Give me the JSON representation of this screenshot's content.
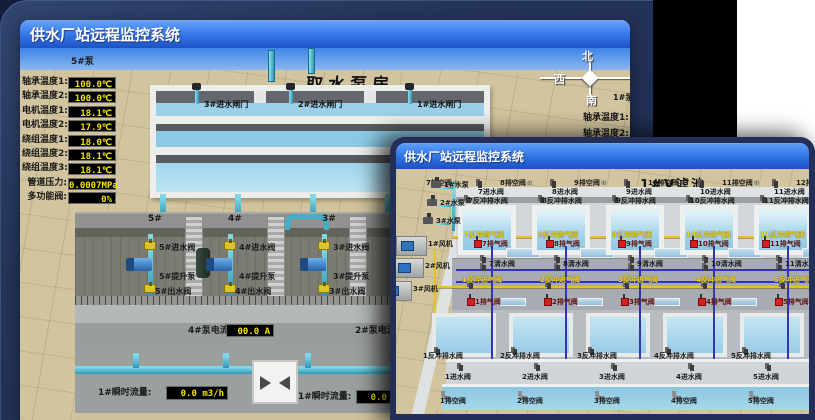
{
  "back_window": {
    "title": "供水厂站远程监控系统",
    "scene_title": "取水泵房",
    "pump_monitor": {
      "pump_label": "5#泵",
      "rows": [
        {
          "label": "轴承温度1:",
          "value": "100.0℃"
        },
        {
          "label": "轴承温度2:",
          "value": "100.0℃"
        },
        {
          "label": "电机温度1:",
          "value": "18.1℃"
        },
        {
          "label": "电机温度2:",
          "value": "17.9℃"
        },
        {
          "label": "绕组温度1:",
          "value": "18.0℃"
        },
        {
          "label": "绕组温度2:",
          "value": "18.1℃"
        },
        {
          "label": "绕组温度3:",
          "value": "18.1℃"
        },
        {
          "label": "管道压力:",
          "value": "0.0007MPa"
        },
        {
          "label": "多功能阀:",
          "value": "0%"
        }
      ]
    },
    "right_monitor": {
      "pump_label": "1#泵",
      "labels": [
        "轴承温度1:",
        "轴承温度2:"
      ]
    },
    "intake_gates": [
      "3#进水闸门",
      "2#进水闸门",
      "1#进水闸门"
    ],
    "compass": {
      "north": "北",
      "west": "西",
      "south": "南"
    },
    "pump_room": {
      "bays": [
        "5#",
        "4#",
        "3#"
      ],
      "groups": [
        {
          "inlet": "5#进水阀",
          "pump": "5#提升泵",
          "outlet": "5#出水阀"
        },
        {
          "inlet": "4#进水阀",
          "pump": "4#提升泵",
          "outlet": "4#出水阀"
        },
        {
          "inlet": "3#进水阀",
          "pump": "3#提升泵",
          "outlet": "3#出水阀"
        }
      ],
      "current_displays": [
        {
          "label": "4#泵电流:",
          "value": "00.0 A"
        },
        {
          "label": "2#泵电流:",
          "value": "00.0 A"
        }
      ]
    },
    "flow_displays": [
      {
        "label": "1#瞬时流量:",
        "value": "0.0 m3/h"
      },
      {
        "label": "1#瞬时流量:",
        "value": "0.0 m3/h"
      }
    ]
  },
  "front_window": {
    "title": "供水厂站远程监控系统",
    "scene_title": "1#V滤池",
    "left_equipment": {
      "pumps": [
        "1#水泵",
        "2#水泵",
        "3#水泵"
      ],
      "fans": [
        "1#风机",
        "2#风机",
        "3#风机"
      ]
    },
    "top_cells": {
      "drain_valves": [
        "7排空阀",
        "8排空阀",
        "9排空阀",
        "10排空阀",
        "11排空阀",
        "12排空阀"
      ],
      "inlet_valves": [
        "7进水阀",
        "8进水阀",
        "9进水阀",
        "10进水阀",
        "11进水阀",
        "12进水阀"
      ],
      "backwash_drain_valves": [
        "7反冲排水阀",
        "8反冲排水阀",
        "9反冲排水阀",
        "10反冲排水阀",
        "11反冲排水阀"
      ],
      "air_inlet_valves": [
        "7反冲进气阀",
        "8反冲进气阀",
        "9反冲进气阀",
        "10反冲进气阀",
        "11反冲进气阀",
        "12反冲进气阀"
      ],
      "exhaust_valves": [
        "7排气阀",
        "8排气阀",
        "9排气阀",
        "10排气阀",
        "11排气阀"
      ],
      "clean_water_valves": [
        "7清水阀",
        "8清水阀",
        "9清水阀",
        "10清水阀",
        "11清水阀"
      ]
    },
    "bottom_cells": {
      "air_inlet_valves": [
        "1反冲进气阀",
        "2反冲进气阀",
        "3反冲进气阀",
        "4反冲进气阀",
        "5反冲进气阀"
      ],
      "exhaust_valves": [
        "1排气阀",
        "2排气阀",
        "3排气阀",
        "4排气阀",
        "5排气阀"
      ],
      "backwash_drain_valves": [
        "1反冲排水阀",
        "2反冲排水阀",
        "3反冲排水阀",
        "4反冲排水阀",
        "5反冲排水阀"
      ],
      "inlet_valves": [
        "1进水阀",
        "2进水阀",
        "3进水阀",
        "4进水阀",
        "5进水阀"
      ],
      "drain_valves": [
        "1排空阀",
        "2排空阀",
        "3排空阀",
        "4排空阀",
        "5排空阀"
      ]
    }
  },
  "colors": {
    "titlebar_top": "#5d9df8",
    "titlebar_bottom": "#1b50c2",
    "display_bg": "#000000",
    "display_text": "#f2e400",
    "alarm_red": "#d42020",
    "pipe_cyan": "#4cc4dc",
    "pipe_yellow": "#e8c020",
    "pipe_blue": "#3434ac",
    "ground_tan": "#d2c49e",
    "panel_navy": "#243459"
  }
}
